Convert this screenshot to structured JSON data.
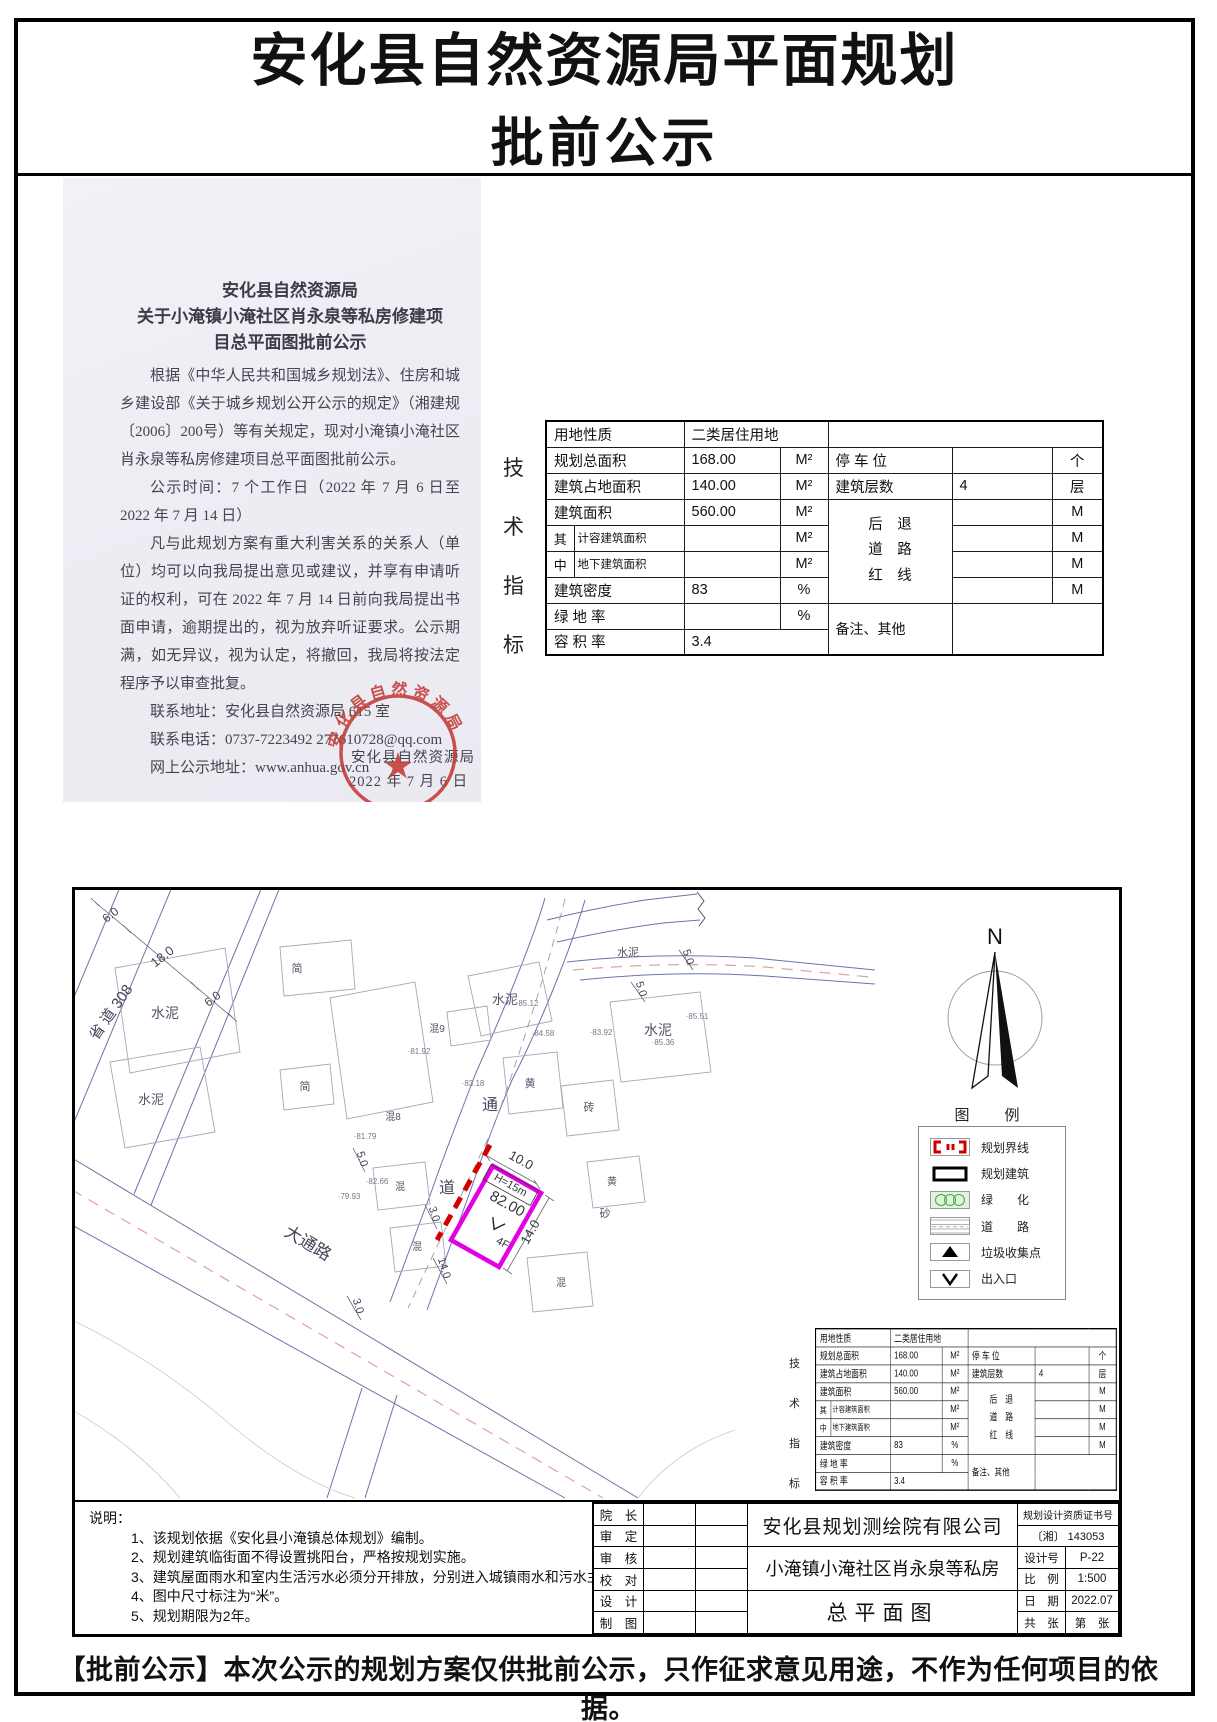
{
  "page": {
    "title_line1": "安化县自然资源局平面规划",
    "title_line2": "批前公示",
    "footer": "【批前公示】本次公示的规划方案仅供批前公示，只作征求意见用途，不作为任何项目的依据。"
  },
  "notice": {
    "heading_line1": "安化县自然资源局",
    "heading_line2": "关于小淹镇小淹社区肖永泉等私房修建项",
    "heading_line3": "目总平面图批前公示",
    "para1": "根据《中华人民共和国城乡规划法》、住房和城乡建设部《关于城乡规划公开公示的规定》（湘建规〔2006〕200号）等有关规定，现对小淹镇小淹社区肖永泉等私房修建项目总平面图批前公示。",
    "para2": "公示时间：7 个工作日（2022 年 7 月 6 日至 2022 年 7 月 14 日）",
    "para3": "凡与此规划方案有重大利害关系的关系人（单位）均可以向我局提出意见或建议，并享有申请听证的权利，可在 2022 年 7 月 14 日前向我局提出书面申请，逾期提出的，视为放弃听证要求。公示期满，如无异议，视为认定，将撤回，我局将按法定程序予以审查批复。",
    "contact_address": "联系地址：安化县自然资源局 615 室",
    "contact_phone": "联系电话：0737-7223492      277610728@qq.com",
    "web_address": "网上公示地址：www.anhua.gov.cn",
    "signature": "安化县自然资源局",
    "date": "2022 年 7 月 6 日",
    "stamp_text": "安化县自然资源局",
    "stamp_color": "#c23b36"
  },
  "tech_table": {
    "side_label": [
      "技",
      "术",
      "指",
      "标"
    ],
    "row1": {
      "label": "用地性质",
      "value": "二类居住用地"
    },
    "row2": {
      "label": "规划总面积",
      "value": "168.00",
      "unit": "M²"
    },
    "row3": {
      "label": "建筑占地面积",
      "value": "140.00",
      "unit": "M²"
    },
    "row4": {
      "label": "建筑面积",
      "value": "560.00",
      "unit": "M²"
    },
    "row5": {
      "prefix": "其",
      "label": "计容建筑面积",
      "value": "",
      "unit": "M²"
    },
    "row6": {
      "prefix": "中",
      "label": "地下建筑面积",
      "value": "",
      "unit": "M²"
    },
    "row7": {
      "label": "建筑密度",
      "value": "83",
      "unit": "%"
    },
    "row8": {
      "label": "绿 地 率",
      "value": "",
      "unit": "%"
    },
    "row9": {
      "label": "容 积 率",
      "value": "3.4"
    },
    "parking": {
      "label": "停 车 位",
      "value": "",
      "unit": "个"
    },
    "floors": {
      "label": "建筑层数",
      "value": "4",
      "unit": "层"
    },
    "setback": {
      "line1": "后　退",
      "line2": "道　路",
      "line3": "红　线",
      "unit": "M"
    },
    "remark": {
      "label": "备注、其他"
    }
  },
  "plan": {
    "north_label": "N",
    "legend": {
      "title": "图　例",
      "items": [
        {
          "icon": "boundary-icon",
          "label": "规划界线"
        },
        {
          "icon": "building-icon",
          "label": "规划建筑"
        },
        {
          "icon": "green-icon",
          "label": "绿　　化"
        },
        {
          "icon": "road-icon",
          "label": "道　　路"
        },
        {
          "icon": "trash-icon",
          "label": "垃圾收集点"
        },
        {
          "icon": "entrance-icon",
          "label": "出入口"
        }
      ]
    },
    "map": {
      "labels": [
        {
          "t": "省 道 308",
          "x": 40,
          "y": 125,
          "r": -55,
          "s": 15,
          "c": "#44445a"
        },
        {
          "t": "6.0",
          "x": 38,
          "y": 28,
          "r": -38,
          "s": 12,
          "c": "#44445a"
        },
        {
          "t": "18.0",
          "x": 90,
          "y": 70,
          "r": -38,
          "s": 13,
          "c": "#44445a"
        },
        {
          "t": "6.0",
          "x": 140,
          "y": 112,
          "r": -38,
          "s": 12,
          "c": "#44445a"
        },
        {
          "t": "通",
          "x": 415,
          "y": 220,
          "r": 0,
          "s": 16,
          "c": "#44445a"
        },
        {
          "t": "道",
          "x": 372,
          "y": 303,
          "r": 0,
          "s": 16,
          "c": "#44445a"
        },
        {
          "t": "大通路",
          "x": 230,
          "y": 358,
          "r": 31,
          "s": 17,
          "c": "#44445a"
        },
        {
          "t": "水泥",
          "x": 90,
          "y": 128,
          "r": 0,
          "s": 14,
          "c": "#555568"
        },
        {
          "t": "简",
          "x": 222,
          "y": 82,
          "r": 0,
          "s": 11,
          "c": "#555568"
        },
        {
          "t": "混9",
          "x": 362,
          "y": 142,
          "r": 0,
          "s": 10,
          "c": "#555568"
        },
        {
          "t": "水泥",
          "x": 430,
          "y": 114,
          "r": 0,
          "s": 13,
          "c": "#555568"
        },
        {
          "t": "水泥",
          "x": 583,
          "y": 145,
          "r": 0,
          "s": 14,
          "c": "#555568"
        },
        {
          "t": "黄",
          "x": 455,
          "y": 197,
          "r": 0,
          "s": 11,
          "c": "#555568"
        },
        {
          "t": "砖",
          "x": 514,
          "y": 221,
          "r": 0,
          "s": 11,
          "c": "#555568"
        },
        {
          "t": "混8",
          "x": 318,
          "y": 230,
          "r": 0,
          "s": 10,
          "c": "#555568"
        },
        {
          "t": "水泥",
          "x": 76,
          "y": 214,
          "r": 0,
          "s": 13,
          "c": "#555568"
        },
        {
          "t": "简",
          "x": 230,
          "y": 200,
          "r": 0,
          "s": 11,
          "c": "#555568"
        },
        {
          "t": "混",
          "x": 325,
          "y": 300,
          "r": 0,
          "s": 10,
          "c": "#555568"
        },
        {
          "t": "混",
          "x": 342,
          "y": 360,
          "r": 0,
          "s": 10,
          "c": "#555568"
        },
        {
          "t": "黄",
          "x": 537,
          "y": 295,
          "r": 0,
          "s": 10,
          "c": "#555568"
        },
        {
          "t": "砂",
          "x": 530,
          "y": 327,
          "r": 0,
          "s": 11,
          "c": "#555568"
        },
        {
          "t": "混",
          "x": 486,
          "y": 396,
          "r": 0,
          "s": 10,
          "c": "#555568"
        },
        {
          "t": "水泥",
          "x": 553,
          "y": 66,
          "r": 0,
          "s": 11,
          "c": "#555568"
        },
        {
          "t": "5.0",
          "x": 563,
          "y": 100,
          "r": 72,
          "s": 11,
          "c": "#44445a"
        },
        {
          "t": "5.0",
          "x": 610,
          "y": 68,
          "r": 72,
          "s": 11,
          "c": "#44445a"
        },
        {
          "t": "·85.12",
          "x": 452,
          "y": 116,
          "r": 0,
          "s": 8,
          "c": "#77778a"
        },
        {
          "t": "·84.58",
          "x": 468,
          "y": 146,
          "r": 0,
          "s": 8,
          "c": "#77778a"
        },
        {
          "t": "·83.92",
          "x": 526,
          "y": 145,
          "r": 0,
          "s": 8,
          "c": "#77778a"
        },
        {
          "t": "·85.36",
          "x": 588,
          "y": 155,
          "r": 0,
          "s": 8,
          "c": "#77778a"
        },
        {
          "t": "·85.51",
          "x": 622,
          "y": 129,
          "r": 0,
          "s": 8,
          "c": "#77778a"
        },
        {
          "t": "·81.92",
          "x": 344,
          "y": 164,
          "r": 0,
          "s": 8,
          "c": "#77778a"
        },
        {
          "t": "·81.79",
          "x": 290,
          "y": 249,
          "r": 0,
          "s": 8,
          "c": "#77778a"
        },
        {
          "t": "·82.66",
          "x": 302,
          "y": 294,
          "r": 0,
          "s": 8,
          "c": "#77778a"
        },
        {
          "t": "·79.93",
          "x": 274,
          "y": 309,
          "r": 0,
          "s": 8,
          "c": "#77778a"
        },
        {
          "t": "·83.18",
          "x": 398,
          "y": 196,
          "r": 0,
          "s": 8,
          "c": "#77778a"
        },
        {
          "t": "10.0",
          "x": 444,
          "y": 274,
          "r": 29,
          "s": 13,
          "c": "#33333f"
        },
        {
          "t": "H=15m",
          "x": 434,
          "y": 298,
          "r": 29,
          "s": 11,
          "c": "#33333f"
        },
        {
          "t": "82.00",
          "x": 430,
          "y": 318,
          "r": 29,
          "s": 15,
          "c": "#33333f"
        },
        {
          "t": "4F",
          "x": 426,
          "y": 356,
          "r": 29,
          "s": 11,
          "c": "#33333f"
        },
        {
          "t": "14.0",
          "x": 459,
          "y": 344,
          "r": -61,
          "s": 13,
          "c": "#33333f"
        },
        {
          "t": "5.0",
          "x": 284,
          "y": 270,
          "r": 72,
          "s": 11,
          "c": "#44445a"
        },
        {
          "t": "3.0",
          "x": 356,
          "y": 325,
          "r": 72,
          "s": 11,
          "c": "#44445a"
        },
        {
          "t": "14.0",
          "x": 366,
          "y": 379,
          "r": 72,
          "s": 11,
          "c": "#44445a"
        },
        {
          "t": "3.0",
          "x": 280,
          "y": 417,
          "r": 72,
          "s": 11,
          "c": "#44445a"
        }
      ]
    },
    "notes": {
      "heading": "说明：",
      "items": [
        "1、该规划依据《安化县小淹镇总体规划》编制。",
        "2、规划建筑临街面不得设置挑阳台，严格按规划实施。",
        "3、建筑屋面雨水和室内生活污水必须分开排放，分别进入城镇雨水和污水主干管。",
        "4、图中尺寸标注为“米”。",
        "5、规划期限为2年。"
      ]
    },
    "title_block": {
      "roles": [
        "院　长",
        "审　定",
        "审　核",
        "校　对",
        "设　计",
        "制　图"
      ],
      "company": "安化县规划测绘院有限公司",
      "project": "小淹镇小淹社区肖永泉等私房",
      "drawing": "总平面图",
      "cert_label": "规划设计资质证书号",
      "cert_no": "〔湘〕 143053",
      "design_no_label": "设计号",
      "design_no": "P-22",
      "scale_label": "比　例",
      "scale": "1:500",
      "date_label": "日　期",
      "date": "2022.07",
      "sheets_total": "共　张",
      "sheets_no": "第　张"
    }
  }
}
